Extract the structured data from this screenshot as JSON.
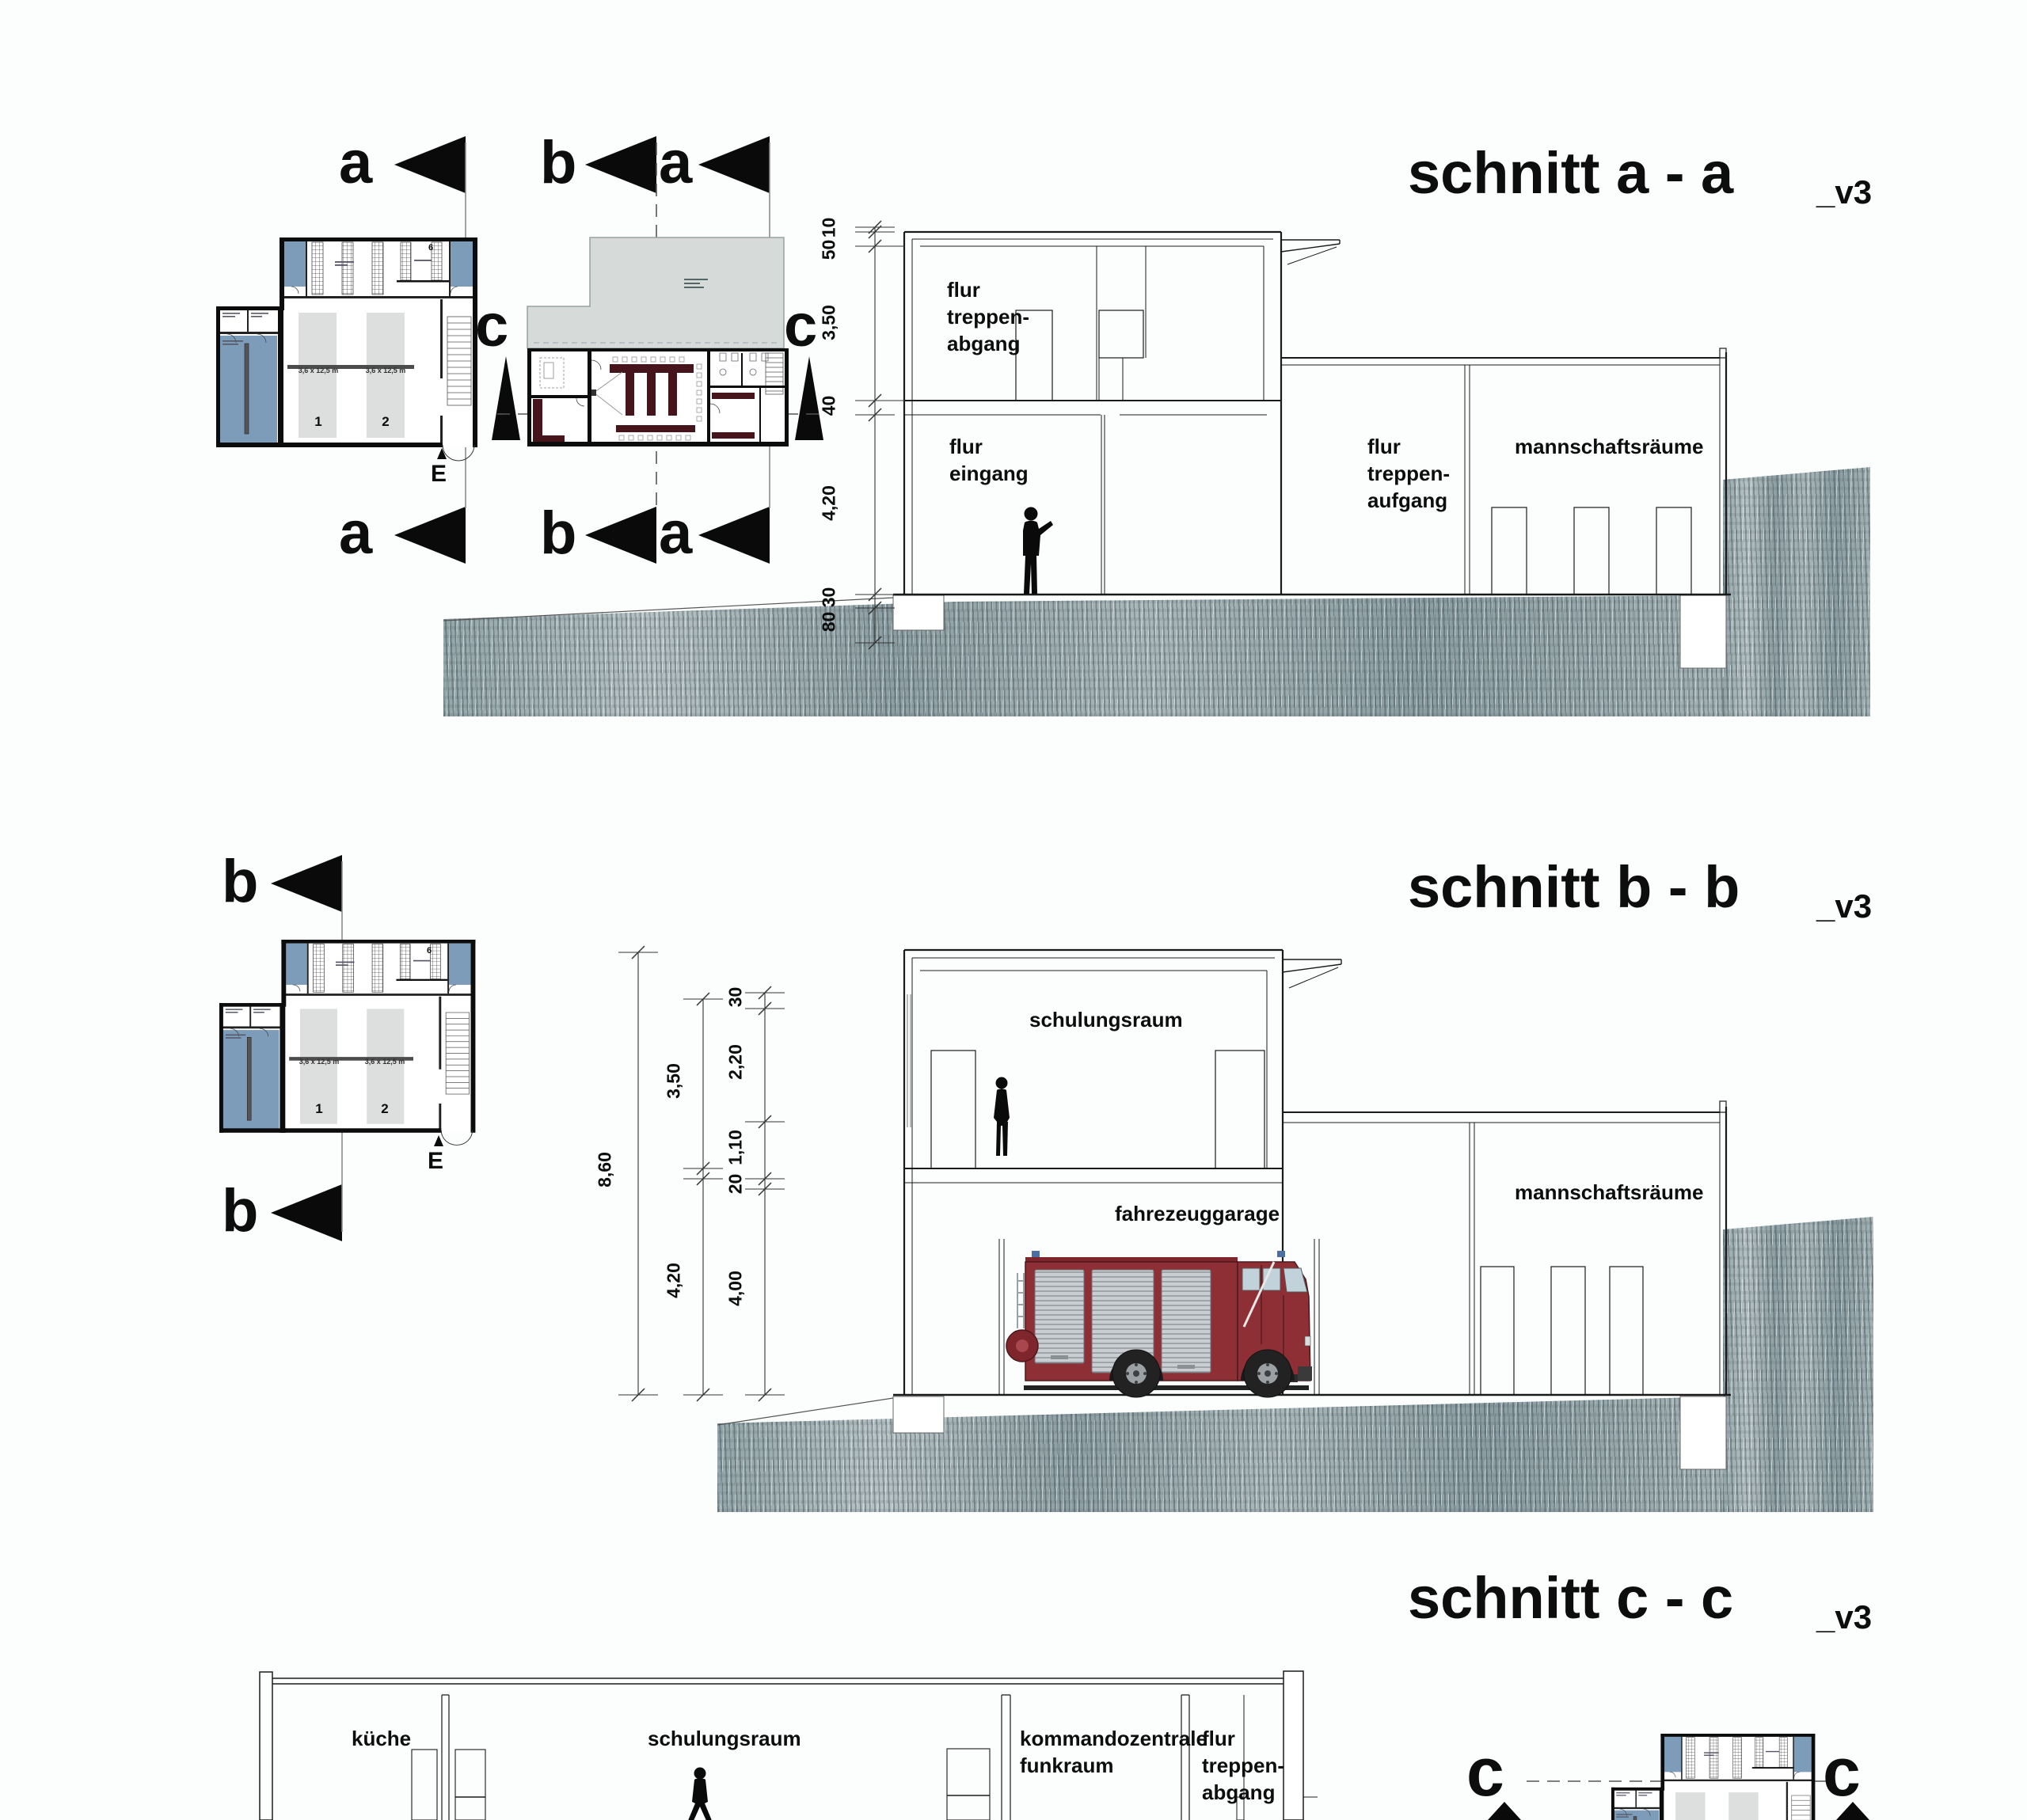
{
  "titles": {
    "section_a": "schnitt a - a",
    "section_b": "schnitt b - b",
    "section_c": "schnitt c - c",
    "version_tag": "_v3"
  },
  "markers": {
    "a": "a",
    "b": "b",
    "c": "c",
    "entrance": "E"
  },
  "section_a": {
    "rooms": {
      "flur_treppen_abgang": "flur\ntreppen-\nabgang",
      "flur_eingang": "flur\neingang",
      "flur_treppen_aufgang": "flur\ntreppen-\naufgang",
      "mannschaftsraeume": "mannschaftsräume"
    },
    "dims": {
      "d10": "10",
      "d50": "50",
      "d350": "3,50",
      "d40": "40",
      "d420": "4,20",
      "d30": "30",
      "d80": "80"
    }
  },
  "section_b": {
    "rooms": {
      "schulungsraum": "schulungsraum",
      "fahrezeuggarage": "fahrezeuggarage",
      "mannschaftsraeume": "mannschaftsräume"
    },
    "dims": {
      "total": "8,60",
      "d350": "3,50",
      "d420": "4,20",
      "d30": "30",
      "d220": "2,20",
      "d110": "1,10",
      "d20": "20",
      "d400": "4,00"
    }
  },
  "section_c": {
    "rooms": {
      "kueche": "küche",
      "schulungsraum": "schulungsraum",
      "kommandozentrale": "kommandozentrale\nfunkraum",
      "flur_treppen_abgang": "flur\ntreppen-\nabgang"
    }
  },
  "plan": {
    "bay_size": "3,6 x 12,5 m",
    "bay_1": "1",
    "bay_2": "2",
    "room_6": "6"
  },
  "colors": {
    "blue_room": "#7d9cba",
    "bay_gray": "#dcdfde",
    "roof_gray": "#d6dbd9",
    "furniture_red": "#45151b",
    "truck_red": "#8e2f35",
    "truck_dark": "#4d181c",
    "ground_base": "#97a8ac"
  }
}
